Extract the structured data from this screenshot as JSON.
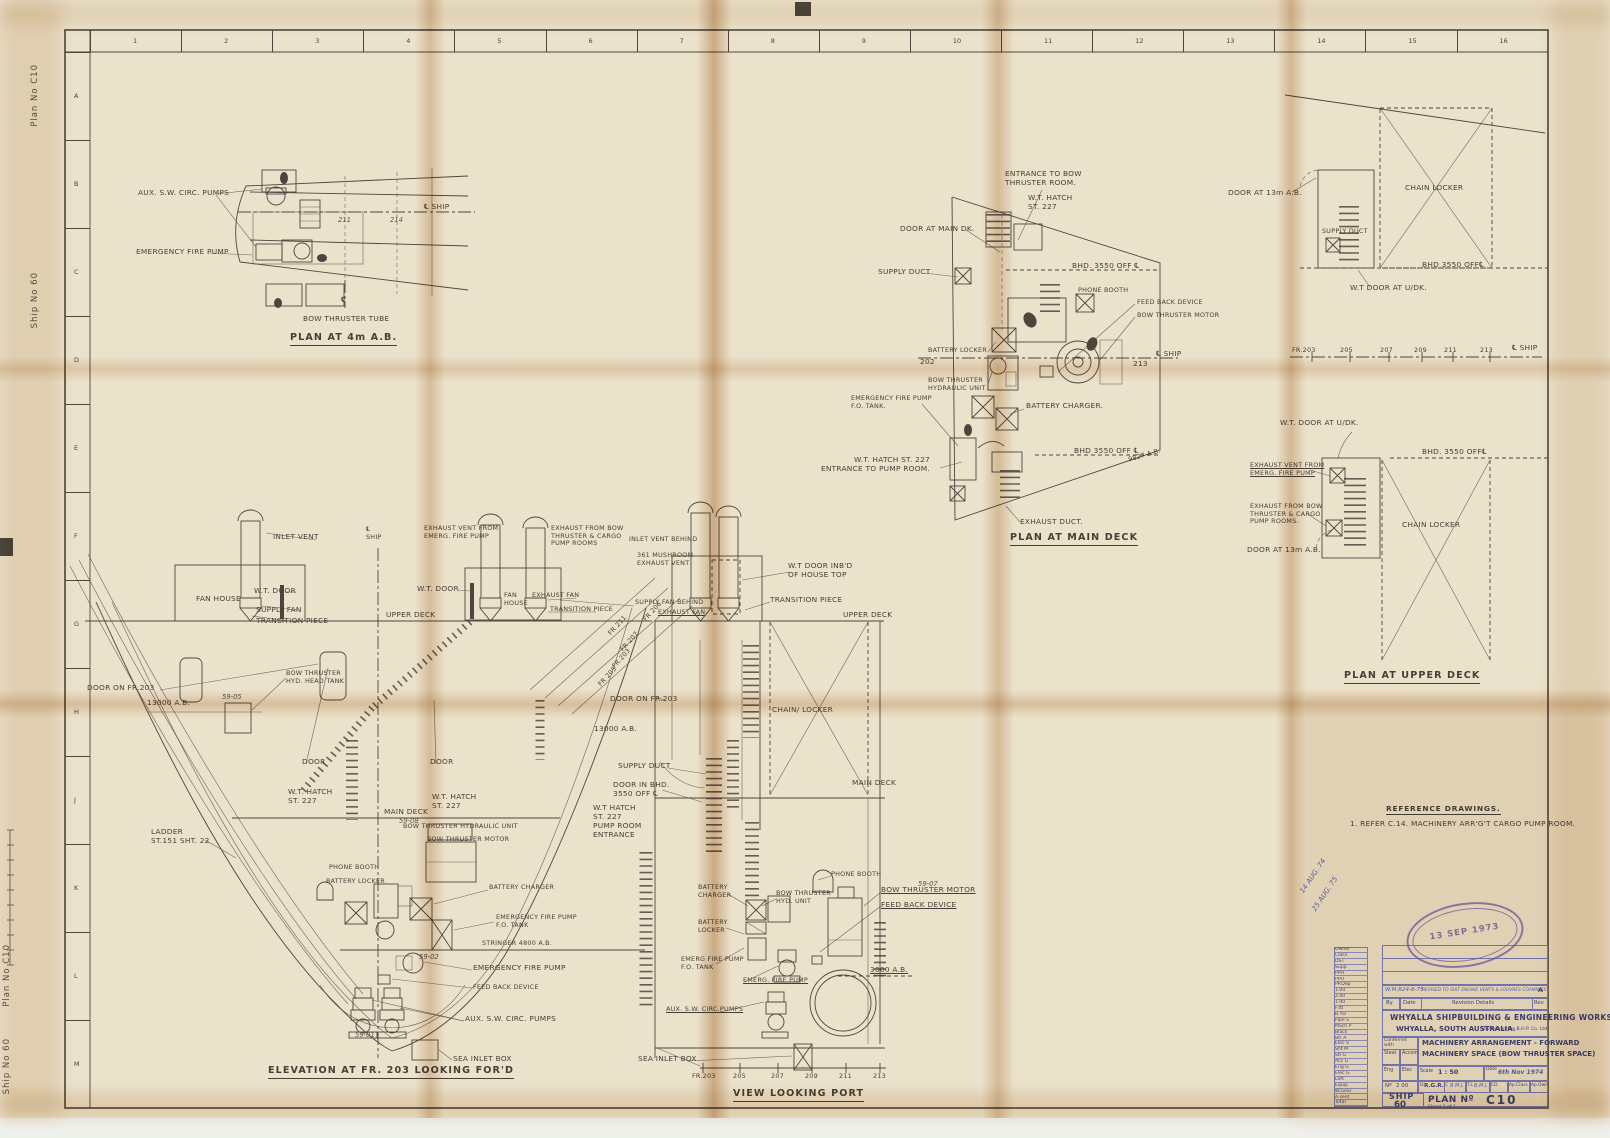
{
  "sheet": {
    "grid_cols": [
      "1",
      "2",
      "3",
      "4",
      "5",
      "6",
      "7",
      "8",
      "9",
      "10",
      "11",
      "12",
      "13",
      "14",
      "15",
      "16"
    ],
    "grid_rows": [
      "A",
      "B",
      "C",
      "D",
      "E",
      "F",
      "G",
      "H",
      "J",
      "K",
      "L",
      "M"
    ],
    "edge_plan": "Plan No C10",
    "edge_ship": "Ship No 60"
  },
  "p4": {
    "aux": "AUX. S.W. CIRC. PUMPS",
    "emerg": "EMERGENCY FIRE PUMP",
    "f211": "211",
    "f214": "214",
    "cl_ship": "℄ SHIP",
    "cl_mark": "℄",
    "tube": "BOW THRUSTER TUBE",
    "title": "PLAN AT 4m A.B."
  },
  "pm": {
    "entrance": "ENTRANCE TO BOW\nTHRUSTER ROOM.",
    "hatch227": "W.T. HATCH\nST. 227",
    "door_main": "DOOR AT MAIN DK.",
    "supply": "SUPPLY DUCT",
    "bhd_top": "BHD. 3550 OFF ℄",
    "phone": "PHONE BOOTH",
    "feed": "FEED BACK DEVICE",
    "motor": "BOW THRUSTER MOTOR",
    "batt_locker": "BATTERY LOCKER",
    "f202": "202",
    "f213": "213",
    "cl_ship": "℄ SHIP",
    "hyd": "BOW THRUSTER\nHYDRAULIC UNIT",
    "charger": "BATTERY CHARGER.",
    "ef_tank": "EMERGENCY FIRE PUMP\nF.O. TANK.",
    "bhd_bot": "BHD 3550 OFF ℄",
    "ab9827": "9827 A.B.",
    "hatch_pump": "W.T. HATCH ST. 227\nENTRANCE TO PUMP ROOM.",
    "exhaust": "EXHAUST DUCT.",
    "title": "PLAN AT MAIN DECK"
  },
  "c1": {
    "door13": "DOOR AT 13m A.B.",
    "chain": "CHAIN LOCKER",
    "supply": "SUPPLY DUCT",
    "bhd": "BHD 3550 OFF℄",
    "wtdoor": "W.T DOOR AT U/DK."
  },
  "fs": {
    "frames": [
      "FR.203",
      "205",
      "207",
      "209",
      "211",
      "213"
    ],
    "ship": "℄ SHIP"
  },
  "c2": {
    "wtdoor": "W.T. DOOR AT U/DK.",
    "bhd": "BHD. 3550 OFF℄",
    "ex_vent": "EXHAUST VENT FROM\nEMERG. FIRE PUMP",
    "ex_from": "EXHAUST FROM BOW\nTHRUSTER & CARGO\nPUMP ROOMS.",
    "door13": "DOOR AT 13m A.B.",
    "chain": "CHAIN LOCKER",
    "title": "PLAN AT UPPER DECK"
  },
  "el": {
    "inlet": "INLET VENT",
    "cl_ship": "℄\nSHIP",
    "exv_emerg": "EXHAUST VENT FROM\nEMERG. FIRE PUMP",
    "exv_bow": "EXHAUST FROM BOW\nTHRUSTER & CARGO\nPUMP ROOMS",
    "inlet_behind": "INLET VENT BEHIND",
    "mushroom": "361 MUSHROOM\nEXHAUST VENT",
    "wt1": "W.T. DOOR",
    "wt2": "W.T. DOOR",
    "fan1": "FAN HOUSE",
    "fan2": "FAN\nHOUSE",
    "sfan": "SUPPLY FAN",
    "exfan1": "EXHAUST FAN",
    "sfan_behind": "SUPPLY FAN BEHIND",
    "trans1": "TRANSITION PIECE",
    "trans2": "TRANSITION PIECE",
    "trans3": "TRANSITION PIECE",
    "wtdoor_inbd": "W.T DOOR INB'D\nOF HOUSE TOP",
    "exfan2": "EXHAUST FAN",
    "udeck1": "UPPER DECK",
    "udeck2": "UPPER DECK",
    "fr206": "FR 206",
    "fr211": "FR 211",
    "fr207": "FR 207",
    "fr203b": "FR.203",
    "fr205": "FR 205",
    "bt_tank": "BOW THRUSTER\nHYD. HEAD TANK",
    "n5905": "59-05",
    "door_fr203a": "DOOR ON FR.203",
    "ab13000a": "13000 A.B.",
    "door1": "DOOR",
    "door2": "DOOR",
    "hatch1": "W.T. HATCH\nST. 227",
    "hatch2": "W.T. HATCH\nST. 227",
    "mdeck1": "MAIN DECK",
    "n5908": "59-08",
    "hyd_unit": "BOW THRUSTER HYDRAULIC UNIT",
    "motor": "BOW THRUSTER MOTOR",
    "ladder": "LADDER\nST.151  SHT. 22",
    "phone1": "PHONE BOOTH",
    "blocker1": "BATTERY LOCKER",
    "charger1": "BATTERY CHARGER",
    "ef_tank": "EMERGENCY FIRE PUMP\nF.O. TANK",
    "stringer": "STRINGER 4800 A.B.",
    "n5902": "59-02",
    "efp": "EMERGENCY FIRE PUMP",
    "feed": "FEED BACK DEVICE",
    "aux": "AUX. S.W. CIRC. PUMPS",
    "n5901": "59-01",
    "sea": "SEA INLET BOX",
    "title": "ELEVATION AT FR. 203 LOOKING FOR'D"
  },
  "vp": {
    "door_fr203": "DOOR ON FR.203",
    "ab13000": "13000 A.B.",
    "chain": "CHAIN/ LOCKER",
    "supply_duct": "SUPPLY DUCT",
    "door_bhd": "DOOR IN BHD.\n3550 OFF ℄",
    "mdeck2": "MAIN DECK",
    "hatch_pump": "W.T HATCH\nST. 227\nPUMP ROOM\nENTRANCE",
    "phone2": "PHONE BOOTH",
    "n5907": "59-07",
    "motor2": "BOW THRUSTER MOTOR",
    "feed2": "FEED BACK DEVICE",
    "charger2": "BATTERY\nCHARGER",
    "hyd2": "BOW THRUSTER\nHYD. UNIT",
    "locker2": "BATTERY\nLOCKER",
    "ef_tank2": "EMERG FIRE PUMP\nF.O. TANK",
    "efp2": "EMERG. FIRE PUMP",
    "ab3000": "3000 A.B.",
    "aux2": "AUX. S.W. CIRC.PUMPS",
    "sea2": "SEA INLET BOX",
    "frames": [
      "FR.203",
      "205",
      "207",
      "209",
      "211",
      "213"
    ],
    "title": "VIEW LOOKING PORT"
  },
  "ref": {
    "heading": "REFERENCE DRAWINGS.",
    "item": "1. REFER C.14.  MACHINERY ARR'G'T CARGO PUMP ROOM."
  },
  "hand": {
    "l1": "14 AUG. 74",
    "l2": "25 AUG. 75"
  },
  "stamp": {
    "date": "13 SEP 1973"
  },
  "tb": {
    "rev_by": "W.M.B",
    "rev_date": "24-8-75",
    "rev_text": "REVISED TO SUIT ENGINE VENTS & LOUVRES COAMINGS",
    "rev_letter": "A",
    "h_by": "By",
    "h_date": "Date",
    "h_details": "Revision Details",
    "h_rev": "Rev",
    "company1": "WHYALLA SHIPBUILDING & ENGINEERING WORKS",
    "company2": "WHYALLA, SOUTH AUSTRALIA.",
    "division": "Division of the B.H.P. Co. Ltd.",
    "conferred": "Conferred\nwith",
    "steel": "Steel",
    "accom": "Accom",
    "eng": "Eng",
    "elec": "Elec",
    "no_label": "Nº",
    "no_value": "2  00",
    "title1": "MACHINERY ARRANGEMENT - FORWARD",
    "title2": "MACHINERY SPACE (BOW THRUSTER SPACE)",
    "scale_label": "Scale",
    "scale": "1 : 50",
    "date_label": "Date",
    "date": "6th Nov 1974",
    "d_label": "D",
    "d": "R.G.R.",
    "c_label": "C",
    "c": "B.M.L",
    "tl_label": "T.L",
    "tl": "B.M.L",
    "cd": "CD",
    "apclass": "Ap.Class",
    "apown": "Ap.Own",
    "ship_label": "SHIP",
    "ship_no": "60",
    "plan_label": "PLAN Nº",
    "plan_no": "C10",
    "sheet": "Sheet 1 of 1",
    "left_rows": [
      "Owner",
      "Class",
      "DST",
      "Supp",
      "PPH",
      "PPO",
      "PP.Dep",
      "1.00",
      "2.00",
      "1.00",
      "F.Itt",
      "B.YD",
      "Pipe S",
      "Mach P",
      "Black",
      "Btr A",
      "Elec S",
      "Sht M",
      "Stl G",
      "Acc G",
      "Eng G",
      "Elec G",
      "Loft",
      "Equip",
      "W.Gear",
      "A.sent",
      "Total"
    ]
  }
}
